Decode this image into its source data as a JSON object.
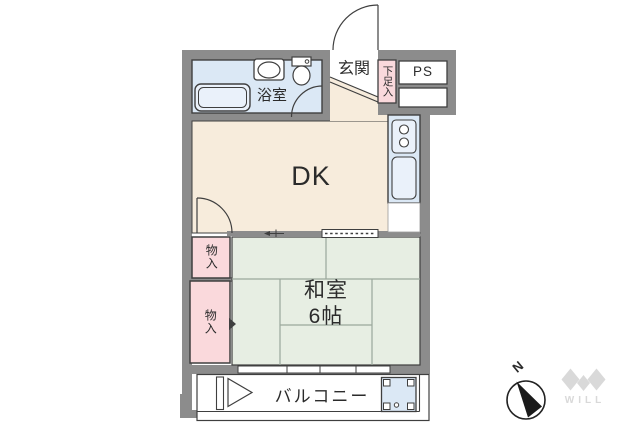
{
  "plan": {
    "rooms": {
      "dining_kitchen": {
        "label": "DK"
      },
      "japanese_room": {
        "name": "和室",
        "size": "6帖"
      },
      "entrance": {
        "label": "玄関"
      },
      "bathroom": {
        "label": "浴室"
      },
      "shoe_storage": {
        "label": "下足入"
      },
      "pipe_space": {
        "label": "PS"
      },
      "storage_top": {
        "label": "物入"
      },
      "storage_bottom": {
        "label": "物入"
      },
      "balcony": {
        "label": "バルコニー"
      }
    },
    "compass": {
      "north": "N"
    },
    "brand": {
      "logo_text": "WILL"
    }
  },
  "colors": {
    "wall": "#8c8c8c",
    "line": "#3f3f3f",
    "dk": "#f7ecdc",
    "wet": "#dbe8f5",
    "wet2": "#eaf1fa",
    "pink": "#fad9dc",
    "tatami": "#e7eee3",
    "tatamiline": "#9aa79c",
    "logo": "#d9d9d9",
    "ink": "#2b2b2b"
  }
}
